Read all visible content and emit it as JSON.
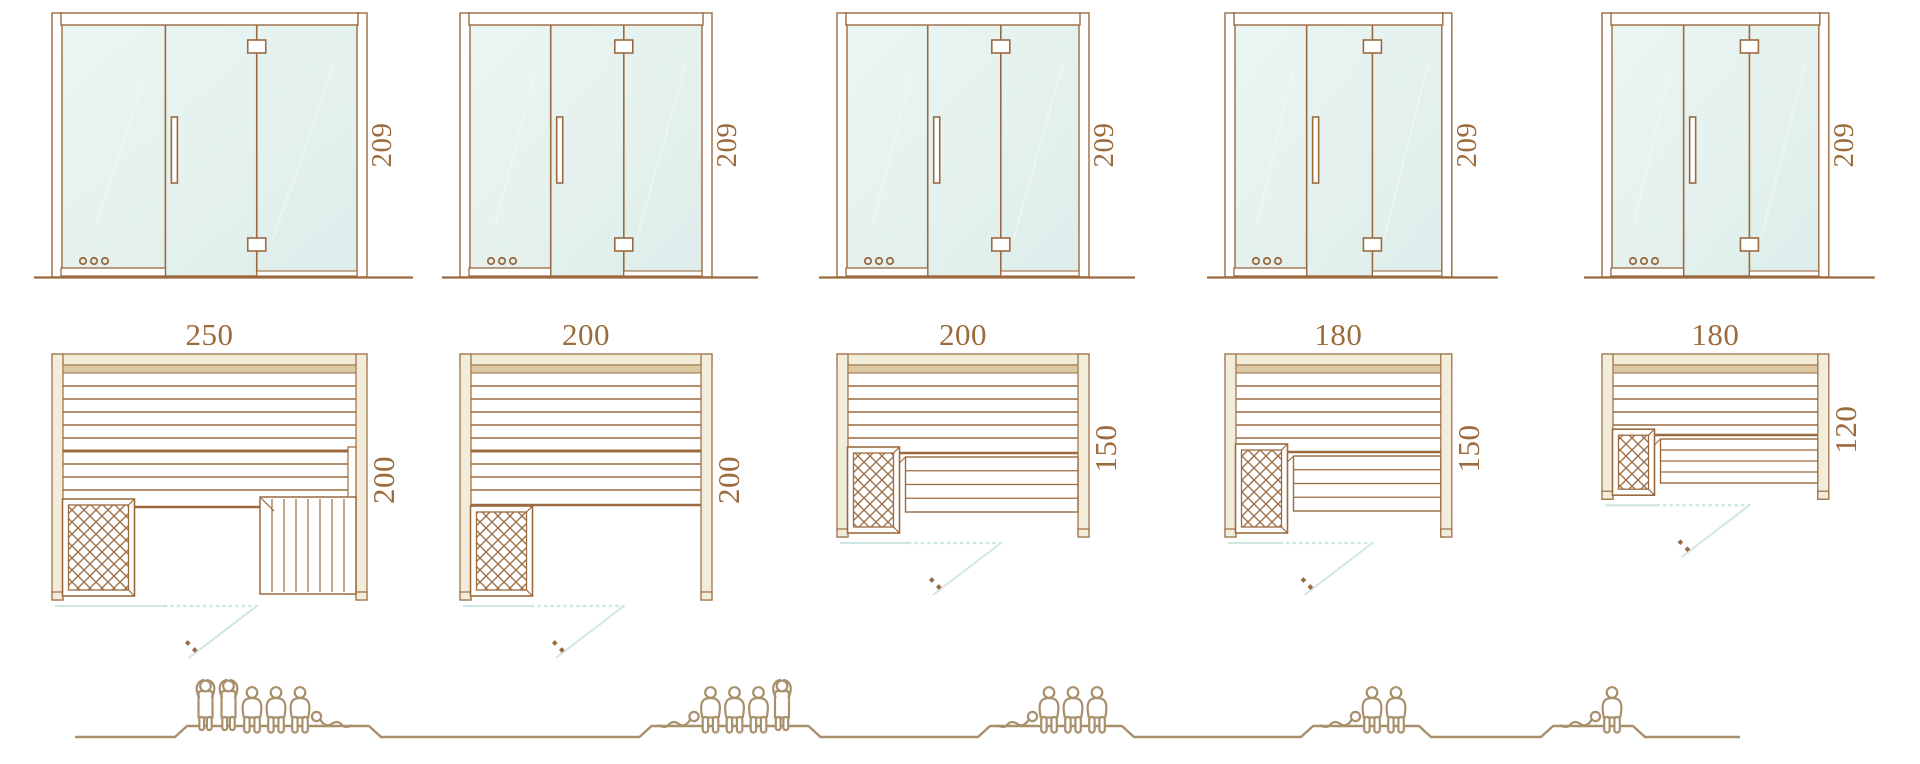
{
  "palette": {
    "line": "#9b6a3f",
    "dim_text": "#9c6b3e",
    "wall_fill": "#f1edda",
    "bench_band": "#dbc9a4",
    "glass_fill": "#e4f1ef",
    "glass_line": "#cfe7e3",
    "people_line": "#a9906c",
    "background": "#ffffff"
  },
  "columns": [
    {
      "height": "209",
      "width": "250",
      "depth": "200",
      "capacity": 6,
      "people": [
        "standing",
        "standing",
        "sitting",
        "sitting",
        "sitting",
        "lying"
      ],
      "lying_head": "left",
      "step_bench": true,
      "side_bench": false
    },
    {
      "height": "209",
      "width": "200",
      "depth": "200",
      "capacity": 5,
      "people": [
        "lying",
        "sitting",
        "sitting",
        "sitting",
        "standing"
      ],
      "lying_head": "right",
      "step_bench": false,
      "side_bench": false
    },
    {
      "height": "209",
      "width": "200",
      "depth": "150",
      "capacity": 4,
      "people": [
        "lying",
        "sitting",
        "sitting",
        "sitting"
      ],
      "lying_head": "right",
      "step_bench": false,
      "side_bench": true
    },
    {
      "height": "209",
      "width": "180",
      "depth": "150",
      "capacity": 3,
      "people": [
        "lying",
        "sitting",
        "sitting"
      ],
      "lying_head": "right",
      "step_bench": false,
      "side_bench": true
    },
    {
      "height": "209",
      "width": "180",
      "depth": "120",
      "capacity": 2,
      "people": [
        "lying",
        "sitting"
      ],
      "lying_head": "right",
      "step_bench": false,
      "side_bench": true
    }
  ]
}
